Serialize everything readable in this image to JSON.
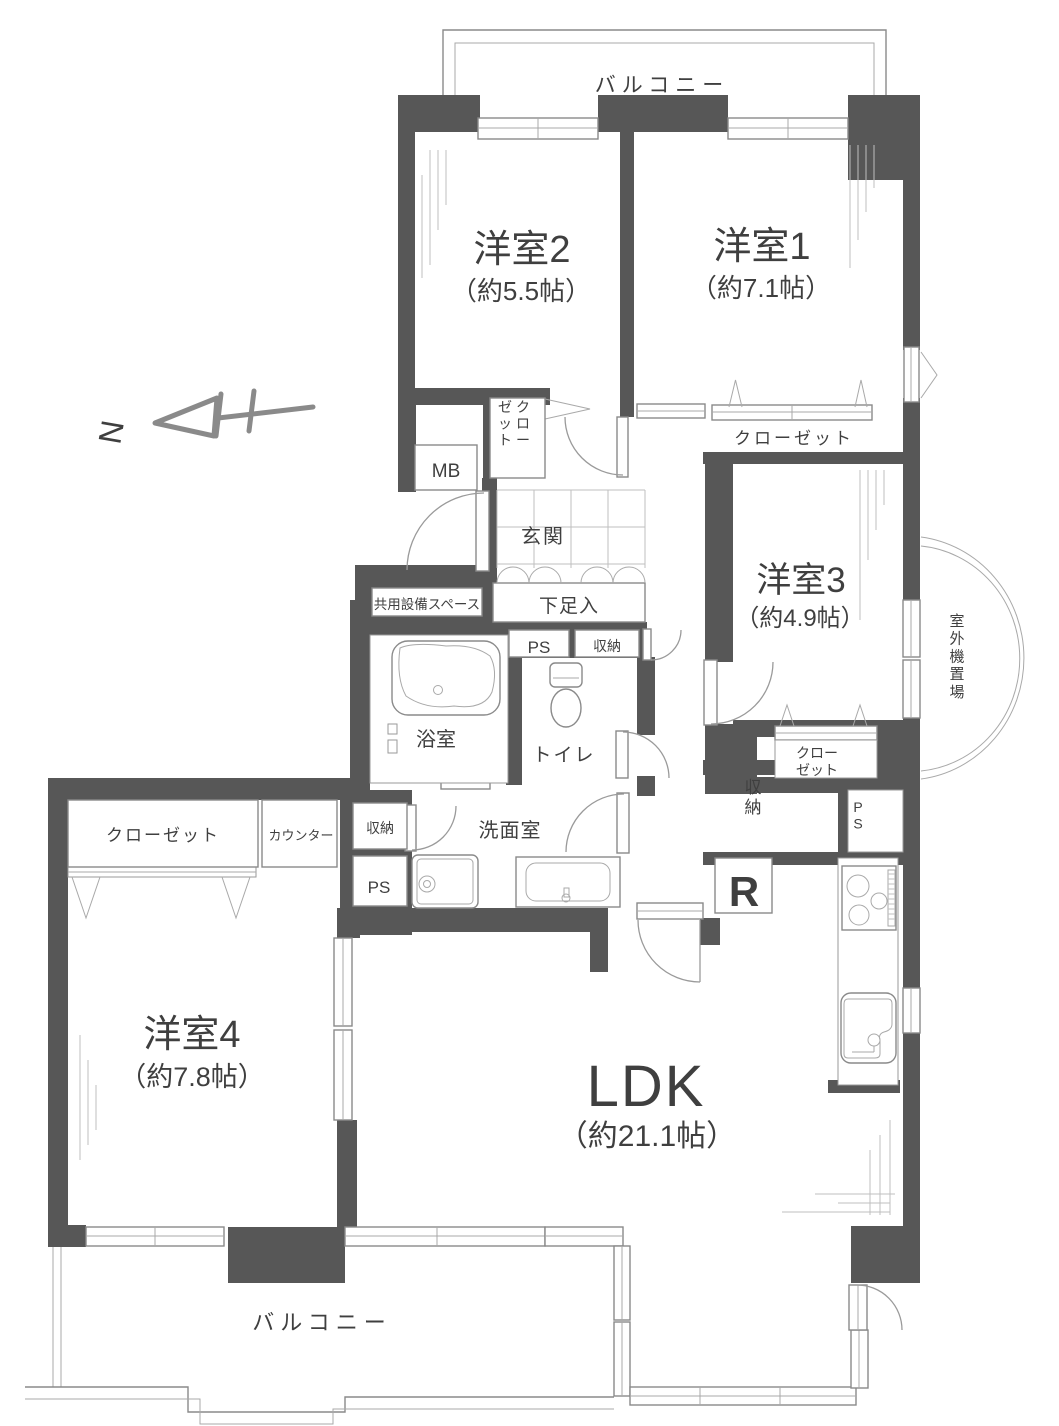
{
  "floorplan": {
    "type": "apartment-floor-plan",
    "colors": {
      "wall": "#575757",
      "line": "#8a8a8a",
      "text": "#3f3f3f"
    },
    "compass": {
      "label": "N"
    },
    "rooms_summary": [
      {
        "name": "洋室1",
        "size": "約7.1帖"
      },
      {
        "name": "洋室2",
        "size": "約5.5帖"
      },
      {
        "name": "洋室3",
        "size": "約4.9帖"
      },
      {
        "name": "洋室4",
        "size": "約7.8帖"
      },
      {
        "name": "LDK",
        "size": "約21.1帖"
      }
    ],
    "labels": [
      {
        "id": "balcony-top",
        "text": "バルコニー",
        "x": 662,
        "y": 92,
        "s": 21,
        "ls": 6
      },
      {
        "id": "room2-name",
        "text": "洋室2",
        "x": 522,
        "y": 262,
        "s": 38
      },
      {
        "id": "room2-size",
        "text": "（約5.5帖）",
        "x": 521,
        "y": 300,
        "s": 26
      },
      {
        "id": "room1-name",
        "text": "洋室1",
        "x": 762,
        "y": 259,
        "s": 38
      },
      {
        "id": "room1-size",
        "text": "（約7.1帖）",
        "x": 761,
        "y": 297,
        "s": 26
      },
      {
        "id": "closet-room1",
        "text": "クローゼット",
        "x": 794,
        "y": 444,
        "s": 17,
        "ls": 3
      },
      {
        "id": "room3-name",
        "text": "洋室3",
        "x": 801,
        "y": 592,
        "s": 35
      },
      {
        "id": "room3-size",
        "text": "（約4.9帖）",
        "x": 800,
        "y": 626,
        "s": 24
      },
      {
        "id": "closet-room3-a",
        "text": "クロー",
        "x": 817,
        "y": 758,
        "s": 14
      },
      {
        "id": "closet-room3-b",
        "text": "ゼット",
        "x": 817,
        "y": 775,
        "s": 14
      },
      {
        "id": "mb-label",
        "text": "MB",
        "x": 446,
        "y": 477,
        "s": 19
      },
      {
        "id": "genkan",
        "text": "玄関",
        "x": 543,
        "y": 543,
        "s": 20,
        "ls": 2
      },
      {
        "id": "shoe-cabinet",
        "text": "下足入",
        "x": 569,
        "y": 612,
        "s": 19,
        "ls": 1
      },
      {
        "id": "shared-space",
        "text": "共用設備スペース",
        "x": 427,
        "y": 609,
        "s": 13.5
      },
      {
        "id": "ps-top",
        "text": "PS",
        "x": 539,
        "y": 653,
        "s": 17
      },
      {
        "id": "shuno-top",
        "text": "収納",
        "x": 607,
        "y": 651,
        "s": 14
      },
      {
        "id": "bath",
        "text": "浴室",
        "x": 436,
        "y": 746,
        "s": 20
      },
      {
        "id": "toilet",
        "text": "トイレ",
        "x": 564,
        "y": 761,
        "s": 19,
        "ls": 2
      },
      {
        "id": "washroom",
        "text": "洗面室",
        "x": 510,
        "y": 837,
        "s": 20,
        "ls": 1
      },
      {
        "id": "shuno-left",
        "text": "収納",
        "x": 380,
        "y": 833,
        "s": 14
      },
      {
        "id": "ps-left",
        "text": "PS",
        "x": 379,
        "y": 893,
        "s": 17
      },
      {
        "id": "closet-room4",
        "text": "クローゼット",
        "x": 163,
        "y": 841,
        "s": 17,
        "ls": 2
      },
      {
        "id": "counter",
        "text": "カウンター",
        "x": 301,
        "y": 840,
        "s": 13
      },
      {
        "id": "room4-name",
        "text": "洋室4",
        "x": 192,
        "y": 1047,
        "s": 38
      },
      {
        "id": "room4-size",
        "text": "（約7.8帖）",
        "x": 192,
        "y": 1086,
        "s": 27
      },
      {
        "id": "ldk-name",
        "text": "LDK",
        "x": 646,
        "y": 1106,
        "s": 58,
        "ls": 2
      },
      {
        "id": "ldk-size",
        "text": "（約21.1帖）",
        "x": 647,
        "y": 1146,
        "s": 30
      },
      {
        "id": "refrigerator",
        "text": "R",
        "x": 744,
        "y": 906,
        "s": 42,
        "w": "bold",
        "c": "#6f6f6f"
      },
      {
        "id": "balcony-bottom",
        "text": "バルコニー",
        "x": 322,
        "y": 1330,
        "s": 22,
        "ls": 6
      },
      {
        "id": "north",
        "text": "N",
        "x": 122,
        "y": 434,
        "s": 32,
        "c": "#8a8a8a",
        "rot": -80
      },
      {
        "id": "closet-genkan-r",
        "text": "クロー",
        "x": 523,
        "y": 412,
        "s": 14,
        "vert": true
      },
      {
        "id": "closet-genkan-l",
        "text": "ゼット",
        "x": 505,
        "y": 412,
        "s": 14,
        "vert": true
      },
      {
        "id": "shuno-hall",
        "text": "収納",
        "x": 753,
        "y": 793,
        "s": 17,
        "vert": true
      },
      {
        "id": "ps-hall",
        "text": "PS",
        "x": 858,
        "y": 812,
        "s": 14,
        "vert": true
      },
      {
        "id": "outdoor-unit",
        "text": "室外機置場",
        "x": 957,
        "y": 626,
        "s": 15,
        "vert": true
      }
    ]
  }
}
